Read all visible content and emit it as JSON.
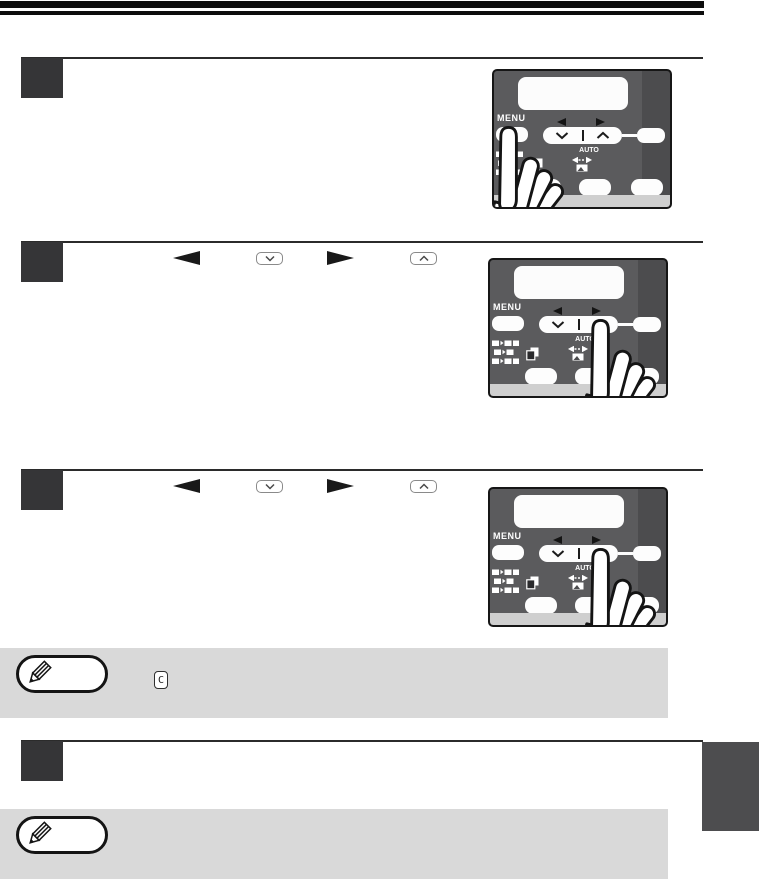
{
  "document": {
    "type": "printer-copier-manual-page"
  },
  "panel": {
    "menu_label": "MENU",
    "auto_label": "AUTO",
    "display": "lcd-blank",
    "buttons": [
      "menu-button",
      "down-up-rocker",
      "ok-button",
      "button-1",
      "button-2",
      "button-3"
    ]
  },
  "steps": [
    {
      "name": "step-1",
      "pressed_button": "menu-key",
      "illustration": "hand-pressing-menu-key"
    },
    {
      "name": "step-2",
      "pressed_button": "up-select-key",
      "illustration": "hand-pressing-up-key",
      "inline_icons": [
        "left-arrow-key",
        "down-select-key",
        "right-arrow-key",
        "up-select-key"
      ]
    },
    {
      "name": "step-3",
      "pressed_button": "up-select-key",
      "illustration": "hand-pressing-up-key",
      "inline_icons": [
        "left-arrow-key",
        "down-select-key",
        "right-arrow-key",
        "up-select-key"
      ]
    },
    {
      "name": "step-4"
    }
  ],
  "notes": [
    {
      "name": "note-1",
      "icons": [
        "pencil-note-icon",
        "clear-key"
      ],
      "clear_key_label": "C"
    },
    {
      "name": "note-2",
      "icons": [
        "pencil-note-icon"
      ]
    }
  ],
  "colors": {
    "rule": "#2b2b2b",
    "step_square": "#353537",
    "panel_body": "#5b5b5d",
    "panel_strip": "#cfcfcf",
    "note_bg": "#d9d9d9",
    "side_tab": "#4d4d4f"
  }
}
